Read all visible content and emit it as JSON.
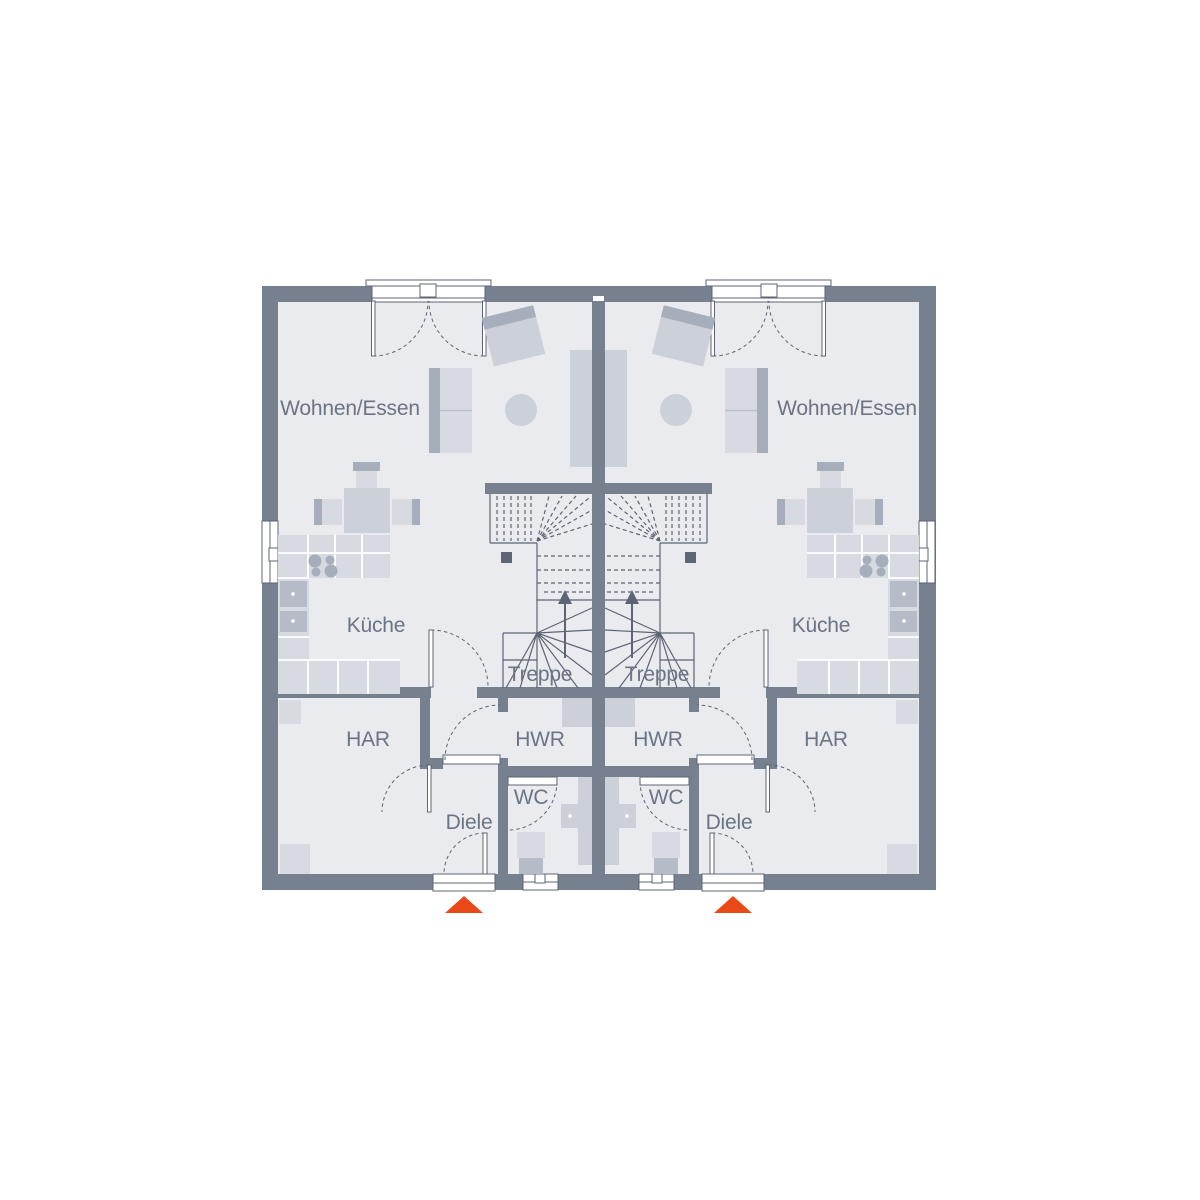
{
  "plan": {
    "type": "floor-plan-ground-floor-duplex",
    "colors": {
      "wall": "#76808f",
      "floor": "#e9ebef",
      "furniture_light": "#d7dbe1",
      "furniture_mid": "#ccd1d9",
      "furniture_dark": "#a7aebb",
      "appliance": "#b6bcc7",
      "line": "#5d6575",
      "label": "#6b7482",
      "entrance_accent": "#e84917",
      "window": "#ffffff",
      "page_bg": "#ffffff"
    },
    "units": [
      {
        "name": "left-unit",
        "rooms": {
          "living": "Wohnen/Essen",
          "kitchen": "Küche",
          "stairs": "Treppe",
          "har": "HAR",
          "hwr": "HWR",
          "wc": "WC",
          "hall": "Diele"
        }
      },
      {
        "name": "right-unit",
        "rooms": {
          "living": "Wohnen/Essen",
          "kitchen": "Küche",
          "stairs": "Treppe",
          "har": "HAR",
          "hwr": "HWR",
          "wc": "WC",
          "hall": "Diele"
        }
      }
    ]
  }
}
